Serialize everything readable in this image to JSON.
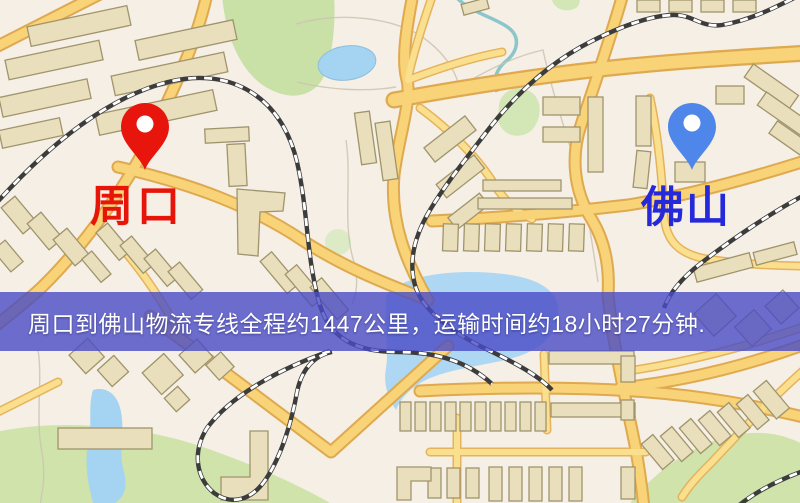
{
  "route_banner": {
    "text": "周口到佛山物流专线全程约1447公里，运输时间约18小时27分钟.",
    "origin": "周口",
    "destination": "佛山",
    "distance_km": "1447",
    "duration_hours": "18",
    "duration_minutes": "27",
    "background_color": "#494bc5",
    "text_color": "#ffffff"
  },
  "markers": {
    "origin": {
      "label": "周口",
      "label_color": "#e71409",
      "pin_color": "#e8150d",
      "pin_icon": "red-location-pin"
    },
    "destination": {
      "label": "佛山",
      "label_color": "#2629da",
      "pin_color": "#4f86ea",
      "pin_icon": "blue-location-pin"
    }
  },
  "map_colors": {
    "background": "#f5efe5",
    "road_fill": "#f8d378",
    "road_casing": "#dfa94f",
    "building": "#eadfbc",
    "park": "#cfe3ab",
    "water": "#a5d3f2",
    "railway": "#3c3c3c"
  }
}
